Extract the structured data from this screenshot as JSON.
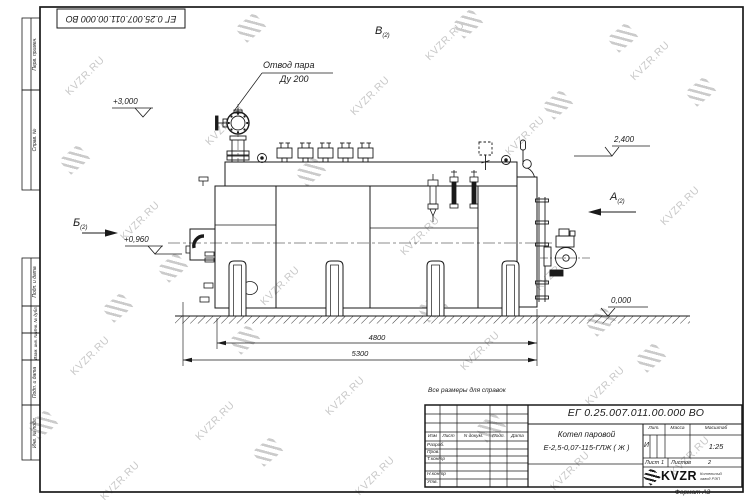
{
  "watermark": {
    "text": "KVZR.RU"
  },
  "corner_stamp": "ЕГ 0.25.007.011.00.000  ВО",
  "note": "Все размеры для справок",
  "margin_labels": {
    "perv_primen": "Перв. примен.",
    "sprav_no": "Справ. №",
    "podp_data_1": "Подп. и дата",
    "inv_dubl": "Инв. № дубл.",
    "vzam_inv": "Взам. инв. №",
    "podp_data_2": "Подп. и дата",
    "inv_podl": "Инв. № подл."
  },
  "drawing": {
    "callout": {
      "line1": "Отвод пара",
      "line2": "Ду 200"
    },
    "views": {
      "a": "А",
      "a_sheet": "(2)",
      "b": "Б",
      "b_sheet": "(2)",
      "v": "В",
      "v_sheet": "(2)"
    },
    "elevations": {
      "top": "+3,000",
      "rear": "2,400",
      "burner": "+0,960",
      "ground": "0,000"
    },
    "dimensions": {
      "inner": "4800",
      "outer": "5300"
    }
  },
  "title_block": {
    "designation": "ЕГ 0.25.007.011.00.000  ВО",
    "product_name_line1": "Котел паровой",
    "product_name_line2": "Е-2,5-0,07-115-ГЛЖ ( Ж )",
    "columns": {
      "izm": "Изм",
      "list": "Лист",
      "n_dokum": "N докум.",
      "podp": "Подп.",
      "data": "Дата"
    },
    "rows": {
      "razrab": "Разраб.",
      "prov": "Пров.",
      "t_kontr": "Т.контр",
      "n_kontr": "Н.контр",
      "utv": "Утв."
    },
    "lit": {
      "header": "Лит.",
      "value": "И"
    },
    "massa": {
      "header": "Масса"
    },
    "masshtab": {
      "header": "Масштаб",
      "value": "1:25"
    },
    "sheet": {
      "label": "Лист",
      "value": "1"
    },
    "sheets": {
      "label": "Листов",
      "value": "2"
    },
    "logo": {
      "text": "KVZR",
      "sub1": "Котельный",
      "sub2": "завод РЭП"
    },
    "format": "Формат А3"
  }
}
